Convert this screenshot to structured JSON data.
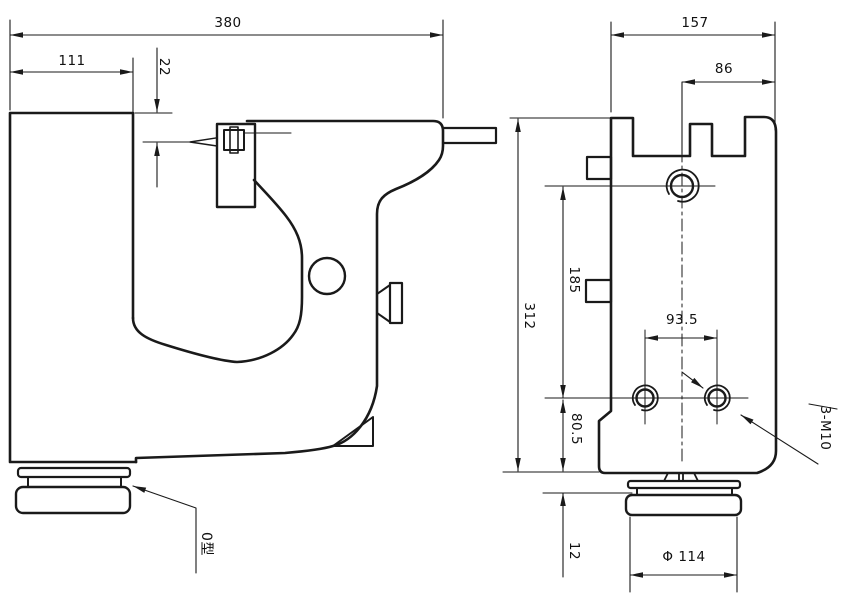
{
  "drawing": {
    "left_view": {
      "dims": {
        "total_width": "380",
        "left_width": "111",
        "top_offset": "22"
      },
      "belt_type_label": "0型"
    },
    "right_view": {
      "dims": {
        "total_width": "157",
        "right_width": "86",
        "total_height": "312",
        "upper_height": "185",
        "lower_height": "80.5",
        "foot_height": "12",
        "hole_spacing": "93.5",
        "pulley_diameter": "Φ 114"
      },
      "thread_label": "3-M10"
    },
    "line_color": "#1a1a1a",
    "background_color": "#ffffff"
  }
}
